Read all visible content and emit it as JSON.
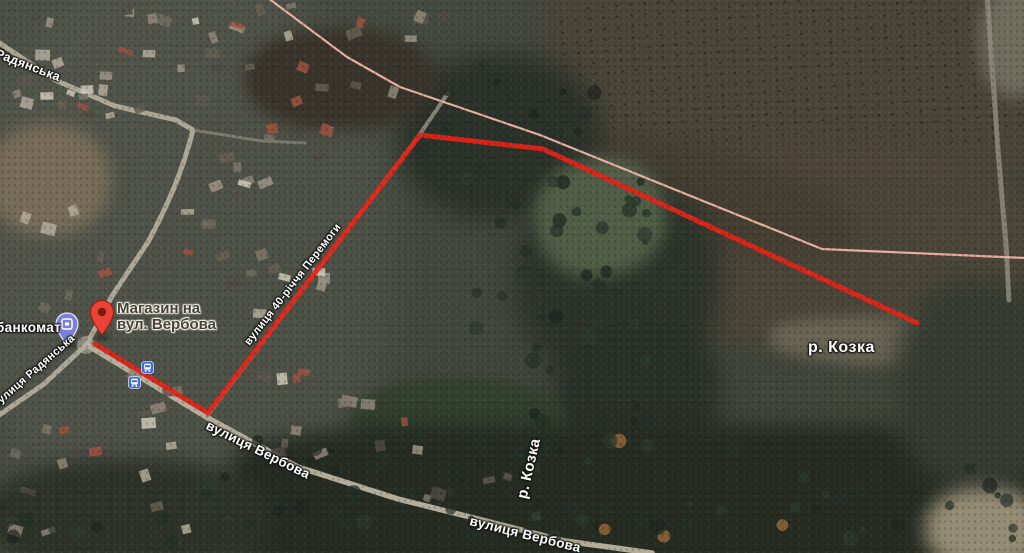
{
  "map": {
    "type": "satellite-view",
    "poi": {
      "label_line1": "Магазин на",
      "label_line2": "вул. Вербова"
    },
    "atm": {
      "label": "банкомат"
    },
    "streets": {
      "radianska_top": "Радянська",
      "radianska_bottom": "вулиця Радянська",
      "peremohy": "вулиця 40-річчя Перемоги",
      "verbova_mid": "вулиця Вербова",
      "verbova_bottom": "вулиця Вербова"
    },
    "rivers": {
      "kozka_right": "р. Козка",
      "kozka_center": "р. Козка"
    },
    "route": {
      "color": "#e32318",
      "width": 5,
      "points": [
        [
          95,
          344
        ],
        [
          208,
          413
        ],
        [
          420,
          135
        ],
        [
          543,
          149
        ],
        [
          917,
          323
        ]
      ]
    },
    "boundary_line": {
      "color": "#f0b4a8",
      "width": 2.2,
      "points": [
        [
          268,
          -2
        ],
        [
          347,
          57
        ],
        [
          400,
          87
        ],
        [
          540,
          135
        ],
        [
          822,
          249
        ],
        [
          1026,
          258
        ]
      ]
    },
    "icon_colors": {
      "place_pin": "#EA4335",
      "atm_pin": "#7b80d8",
      "bus_stop": "#3d6be0"
    }
  }
}
